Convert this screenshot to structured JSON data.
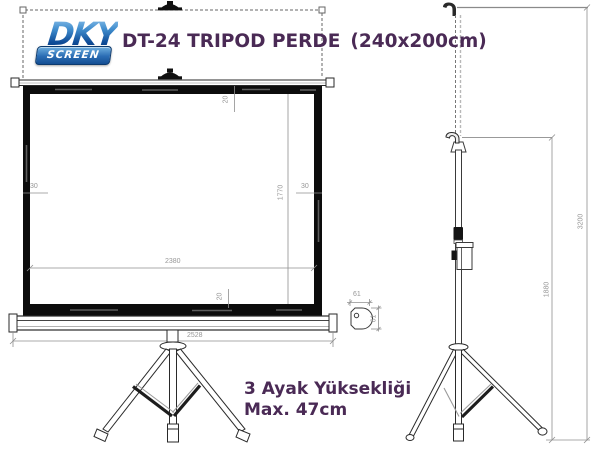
{
  "logo": {
    "name": "DKY",
    "subname": "SCREEN"
  },
  "title": {
    "model": "DT-24 TRIPOD PERDE",
    "size": "(240x200cm)"
  },
  "front_view": {
    "dim_top_border": "20",
    "dim_bottom_border": "20",
    "dim_left_border": "30",
    "dim_right_border": "30",
    "dim_viewing_width": "2380",
    "dim_viewing_height": "1770",
    "dim_total_width": "2528"
  },
  "side_view": {
    "dim_total_height": "3200",
    "dim_case_height": "1880"
  },
  "detail_view": {
    "dim_width": "61",
    "dim_height": "61"
  },
  "note": {
    "line1": "3 Ayak Yüksekliği",
    "line2": "Max. 47cm"
  },
  "colors": {
    "accent_purple": "#4a2a55",
    "logo_blue": "#1c5ca6",
    "dim_gray": "#979797",
    "frame_black": "#0c0c0c"
  }
}
